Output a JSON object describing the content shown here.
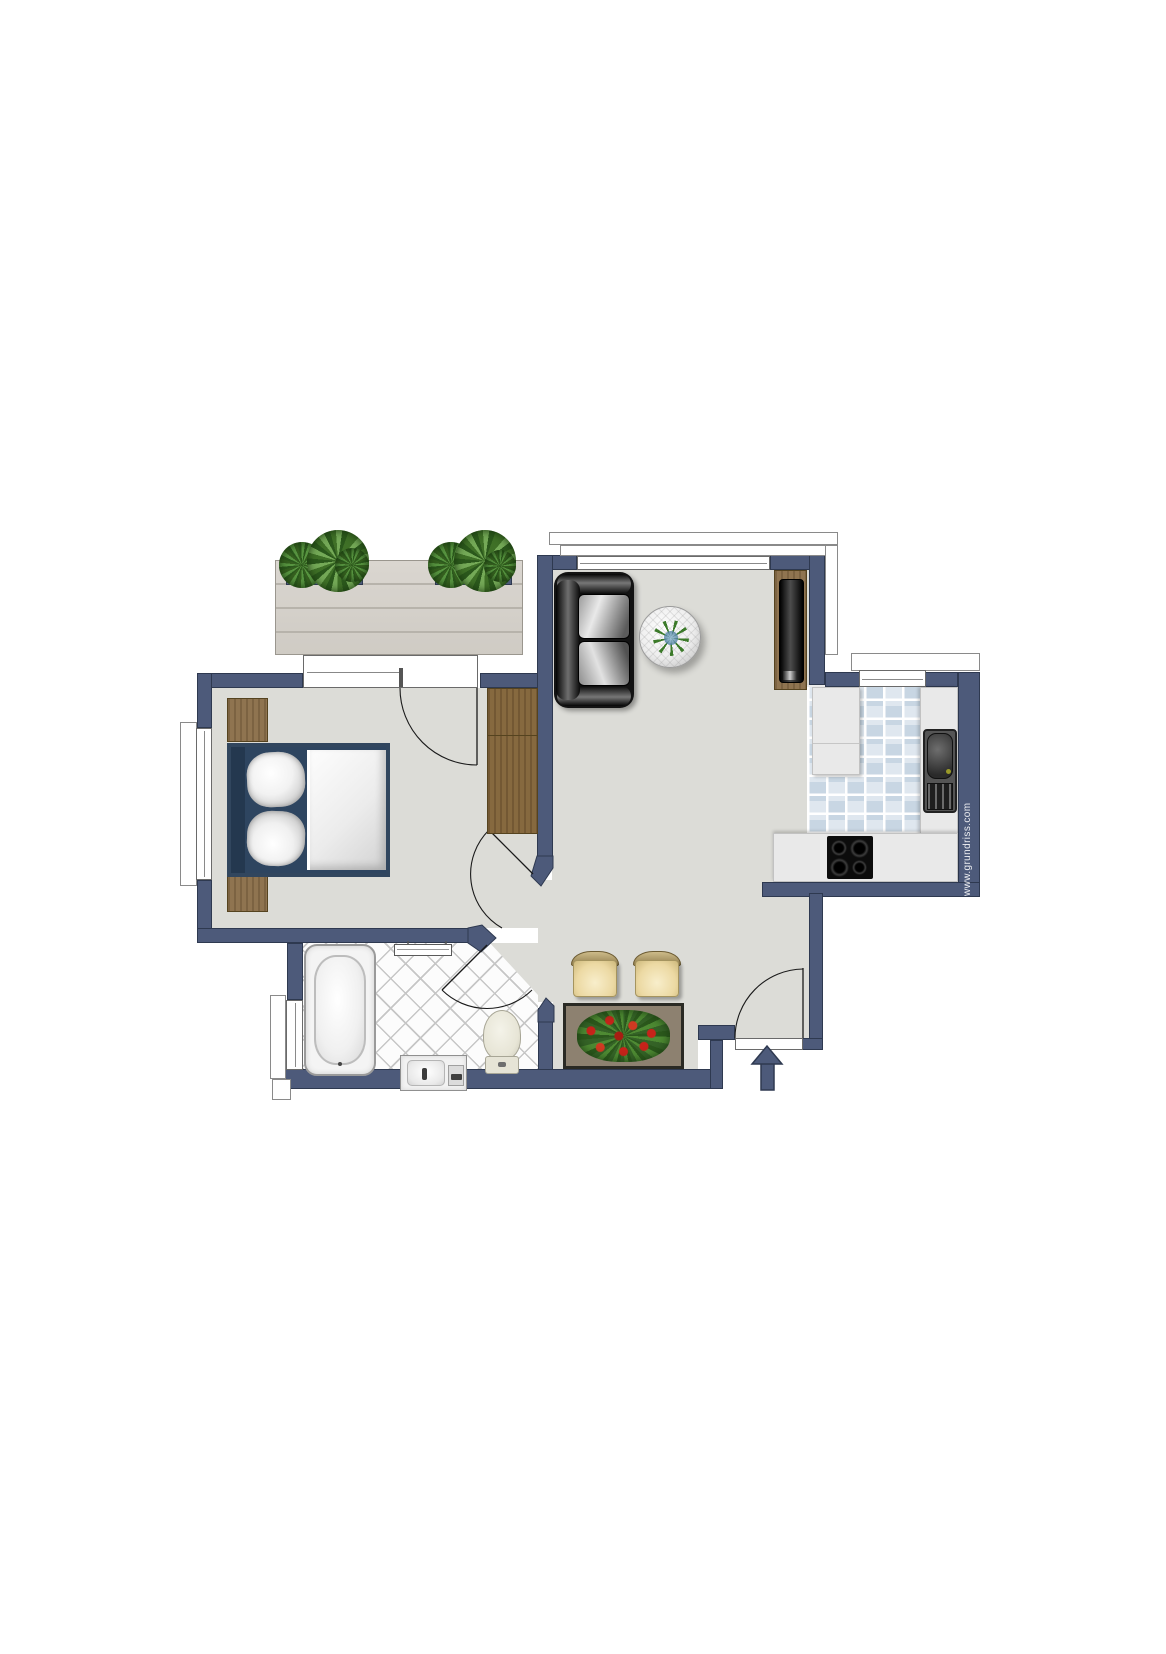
{
  "watermark": {
    "text": "www.grundriss.com"
  },
  "palette": {
    "wall": "#4d5a7a",
    "wall-outline": "#2e3950",
    "floor": "#dcdcd7",
    "tile-a": "#c8d6e3",
    "tile-b": "#dfe7ef",
    "wood": "#8f7450",
    "deck": "#d7d3cc",
    "counter": "#e9e9e9",
    "cream": "#efdfae",
    "table-top": "#8d8170",
    "flower-red": "#c7231a",
    "plant-green": "#3f7a2a",
    "appliance-black": "#0c0c0c"
  },
  "plan": {
    "rooms": [
      "balcony",
      "bedroom",
      "living-room",
      "kitchen",
      "hall",
      "bathroom",
      "entrance"
    ],
    "furniture": [
      "balcony-planter",
      "double-bed",
      "nightstand",
      "wardrobe",
      "sofa",
      "round-glass-table",
      "tv-sideboard",
      "kitchen-cabinet",
      "kitchen-sink",
      "cooktop",
      "dining-chair",
      "dining-table",
      "flower-arrangement",
      "bathtub",
      "radiator",
      "toilet",
      "vanity-sink",
      "entrance-arrow"
    ]
  }
}
